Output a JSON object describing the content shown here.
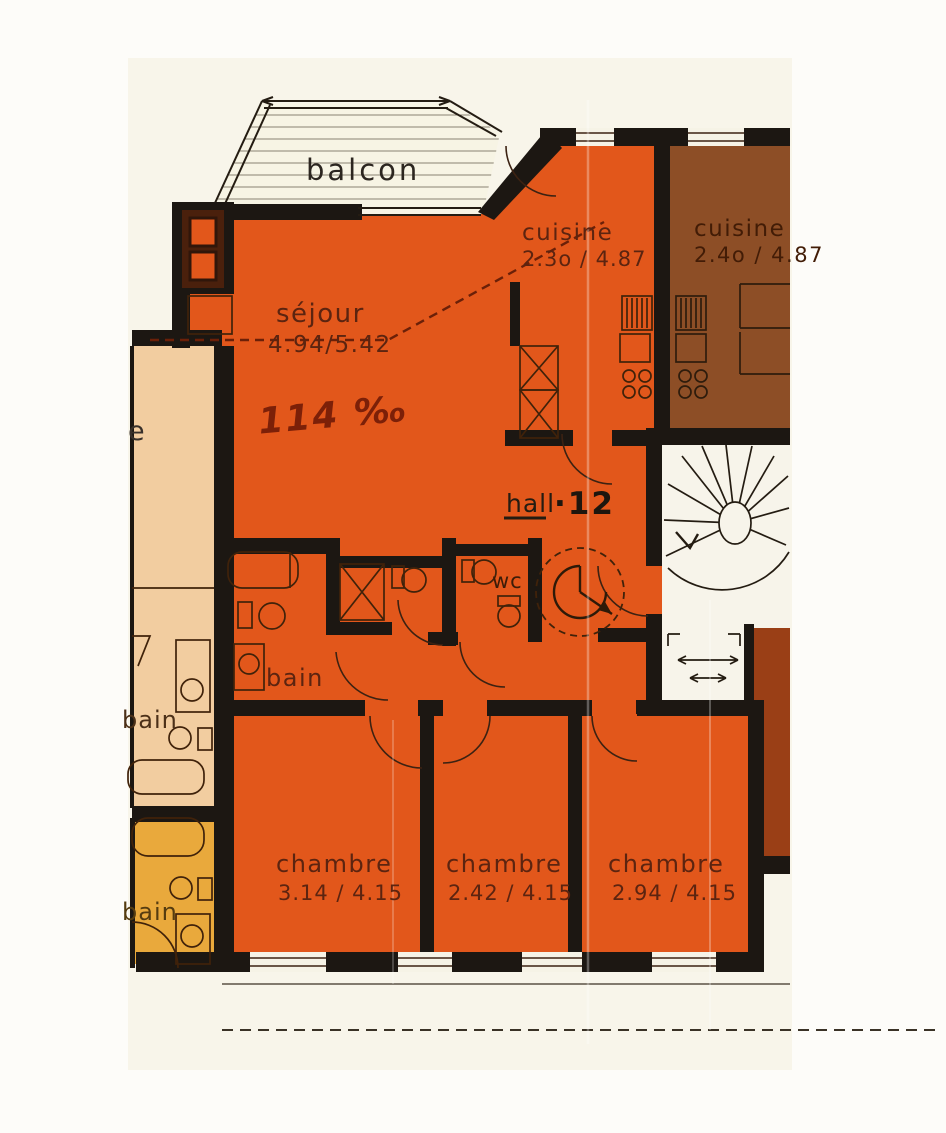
{
  "colors": {
    "apartment_orange": "#e2571b",
    "neighbor_kitchen_brown": "#8d4e26",
    "neighbor_right_brown": "#9a3f16",
    "neighbor_left_peach": "#f2cda0",
    "neighbor_lower_yellow": "#e9a93c",
    "walls_black": "#1c1712",
    "paper": "#f8f5ea",
    "balcony_paper": "#f7f4e4"
  },
  "labels": {
    "balcony": "balcon",
    "kitchen": {
      "name": "cuisine",
      "dims": "2.3o / 4.87"
    },
    "neighbor_kitchen": {
      "name": "cuisine",
      "dims": "2.4o / 4.87"
    },
    "living_room": {
      "name": "séjour",
      "dims": "4.94/5.42"
    },
    "slope_note": "114 ‰",
    "hall": {
      "name": "hall",
      "unit_number": "·12"
    },
    "wc": "wc",
    "bathroom": "bain",
    "neighbor_bathroom_left": "bain",
    "neighbor_bathroom_lower": "bain",
    "neighbor_room_partial": "e",
    "bedroom_1": {
      "name": "chambre",
      "dims": "3.14 / 4.15"
    },
    "bedroom_2": {
      "name": "chambre",
      "dims": "2.42 / 4.15"
    },
    "bedroom_3": {
      "name": "chambre",
      "dims": "2.94 / 4.15"
    }
  }
}
